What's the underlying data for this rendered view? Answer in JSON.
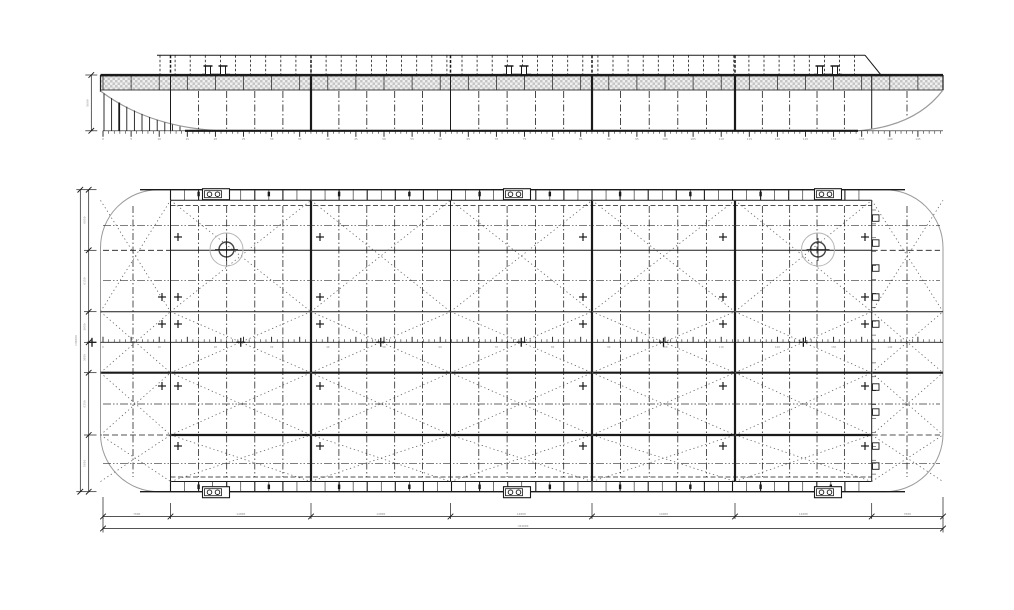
{
  "drawing": {
    "title": "barge-general-arrangement",
    "canvas": {
      "width": 1014,
      "height": 610
    },
    "colors": {
      "ink": "#1a1a1a",
      "light": "#9a9a9a",
      "brace": "#5a5a5a",
      "dim_text": "#8f8f8f",
      "hatch_dark": "#c6c6c6",
      "hatch_light": "#efefef",
      "background": "#ffffff"
    },
    "hull": {
      "left_x": 100.5,
      "right_x": 943,
      "bulkheads_x": [
        170.5,
        311,
        450.5,
        592,
        735,
        871.7
      ],
      "heavy_bulkheads_x": [
        311,
        592,
        735
      ]
    },
    "elevation": {
      "rail_top_y": 55.2,
      "rail_start_x": 157,
      "rail_end_x": 865,
      "rail_diag_end_x": 881,
      "post_spacing": 15.1,
      "deck_y": 75,
      "band_bottom_y": 90,
      "keel_y": 130.8,
      "keel_solid_start_x": 185,
      "keel_solid_end_x": 858,
      "bow_curve_end_x": 220,
      "stern_curve_start_x": 858,
      "bollards_x": [
        216,
        517,
        828
      ],
      "depth_dim": {
        "line_x": 91.3,
        "label": "5600"
      },
      "ruler": {
        "start_x": 103,
        "end_x": 943,
        "minor_step": 5.62,
        "majors_every": 5,
        "labels_y": 140
      }
    },
    "plan": {
      "top_y": 189.7,
      "bottom_y": 491.7,
      "corner_r": 58,
      "strip": {
        "top_solid_y": 200.3,
        "top_dash_y": 205.5,
        "bottom_solid_y": 481.5,
        "bottom_dash_y": 477,
        "tick_step": 14.05
      },
      "girders": [
        {
          "y": 250.3,
          "w": 1,
          "mid_solid": true
        },
        {
          "y": 311.7,
          "w": 1,
          "full": true
        },
        {
          "y": 372.7,
          "w": 2.2,
          "full": true
        },
        {
          "y": 435,
          "w": 2.2,
          "mid_solid": true
        }
      ],
      "centerline_y": 342.3,
      "mid_dash_y": [
        225.3,
        280.7,
        404,
        463.3
      ],
      "x_brace_bands": [
        [
          200.3,
          311.7
        ],
        [
          311.7,
          372.7
        ],
        [
          372.7,
          435
        ],
        [
          435,
          481.5
        ]
      ],
      "circles": [
        {
          "x": 226.5,
          "y": 249.5
        },
        {
          "x": 818,
          "y": 249.5
        }
      ],
      "bollards_x": [
        216,
        517,
        828
      ],
      "crosses": [
        {
          "x": 162,
          "ys": [
            297,
            324,
            386
          ]
        },
        {
          "x": 178,
          "ys": [
            237,
            297,
            324,
            386,
            446
          ]
        },
        {
          "x": 320,
          "ys": [
            237,
            297,
            324,
            386,
            446
          ]
        },
        {
          "x": 583,
          "ys": [
            237,
            297,
            324,
            386,
            446
          ]
        },
        {
          "x": 723,
          "ys": [
            237,
            297,
            324,
            386,
            446
          ]
        },
        {
          "x": 865,
          "ys": [
            237,
            297,
            324,
            386,
            446
          ]
        }
      ],
      "brackets": {
        "x": 872.5,
        "rows": [
          218,
          243,
          268,
          297,
          324,
          387,
          412,
          446,
          466
        ]
      },
      "rake_frames_x": [
        133,
        907
      ]
    },
    "frame_labels": [
      "0",
      "5",
      "10",
      "15",
      "20",
      "25",
      "30",
      "35",
      "40",
      "45",
      "50",
      "55",
      "60",
      "65",
      "70",
      "75",
      "80",
      "85",
      "90",
      "95",
      "100",
      "105",
      "110",
      "115",
      "120",
      "125",
      "130",
      "135",
      "140",
      "145",
      "150"
    ],
    "dims_bottom": {
      "line1_y": 516.5,
      "line2_y": 528.5,
      "ticks": [
        103,
        170.5,
        311,
        450.5,
        592,
        735,
        871.7,
        943
      ],
      "segment_labels": [
        "7000",
        "14000",
        "14000",
        "14000",
        "14000",
        "14000",
        "7000"
      ],
      "overall_label": "≈84000"
    },
    "dims_left": {
      "line1_x": 88.7,
      "line2_x": 80.3,
      "ticks": [
        189.7,
        250.3,
        311.7,
        342.3,
        372.7,
        435,
        491.7
      ],
      "segment_labels": [
        "6050",
        "6150",
        "3050",
        "3050",
        "6250",
        "5650"
      ],
      "overall_label": "≈30000"
    }
  }
}
